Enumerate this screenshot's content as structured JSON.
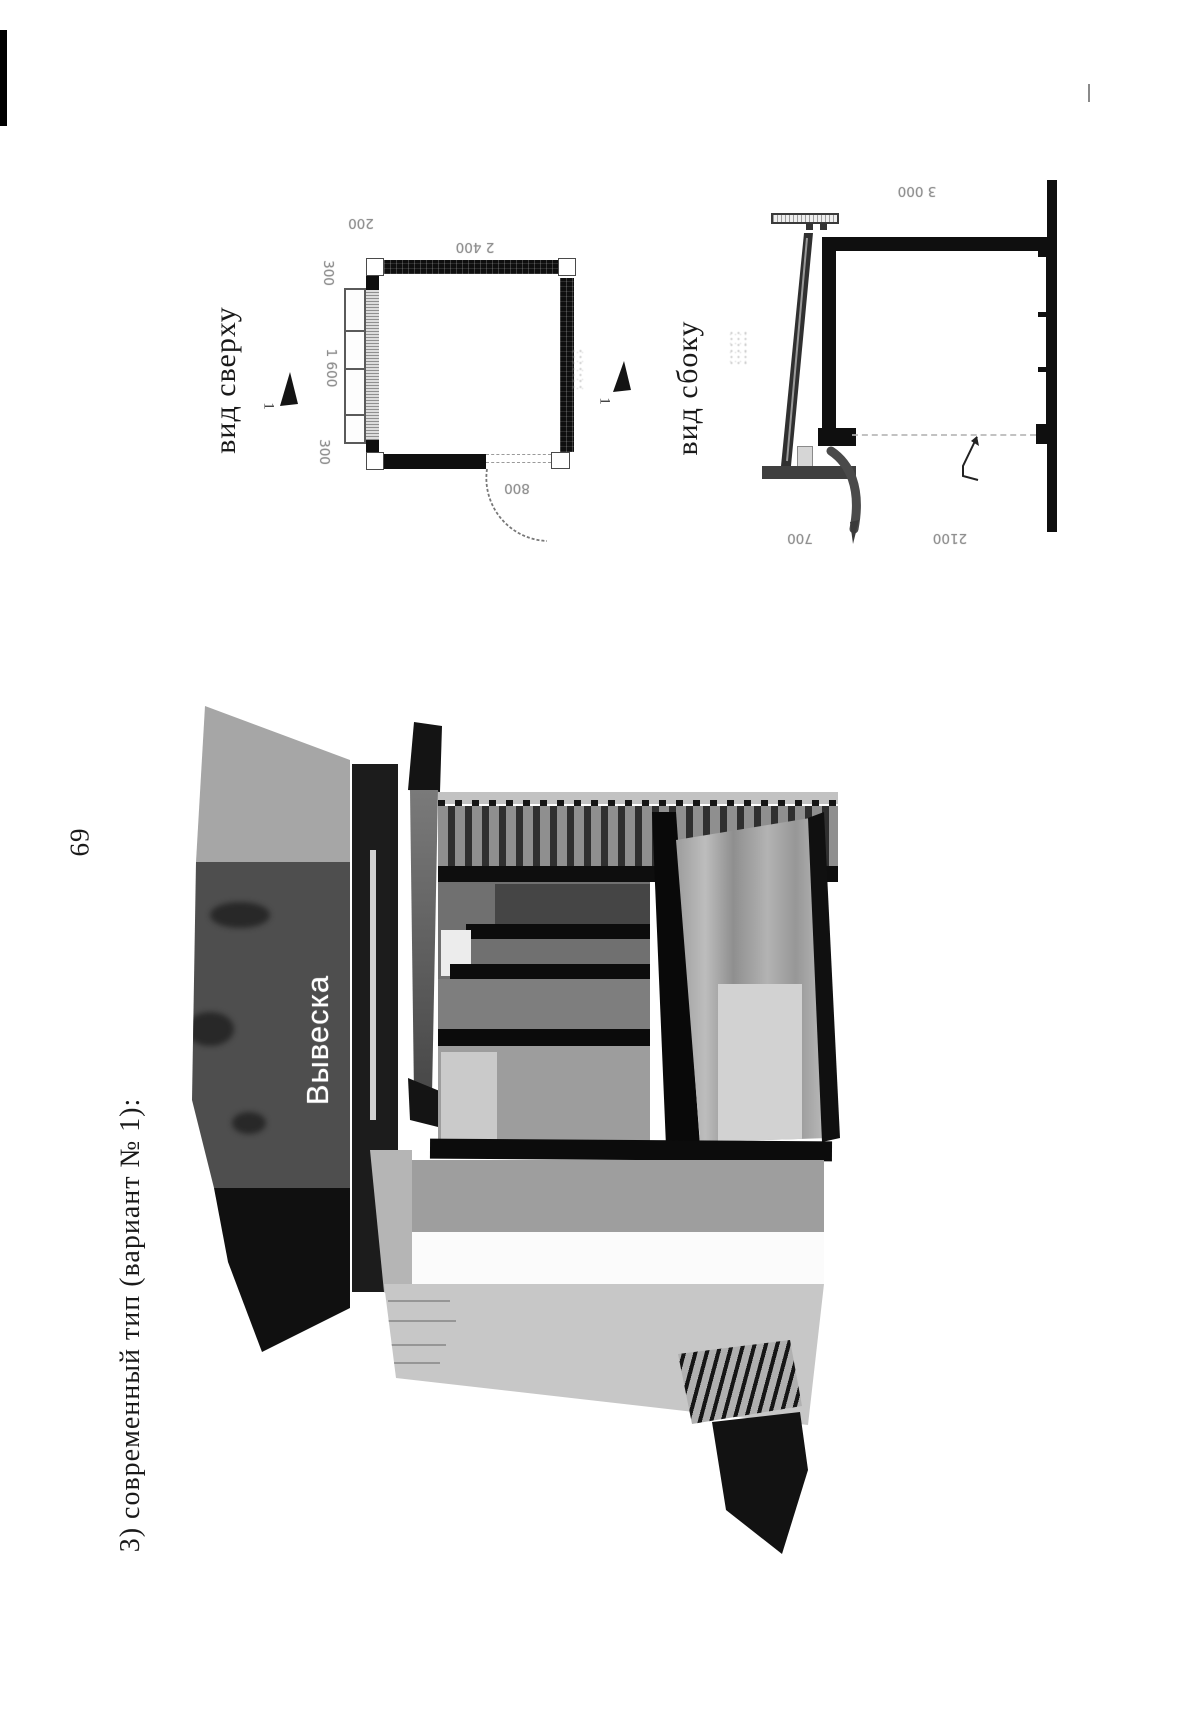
{
  "page": {
    "number": "69",
    "caption": "3) современный тип (вариант № 1):"
  },
  "figure": {
    "top_view": {
      "label": "вид сверху",
      "section_number": "1",
      "dimensions": {
        "wall_offset": "200",
        "width": "2 400",
        "side_top": "300",
        "side_middle": "1 600",
        "side_bottom": "300",
        "door_width": "800"
      }
    },
    "side_view": {
      "label": "вид сбоку",
      "section_number": "1",
      "dimensions": {
        "total_height": "3 000",
        "sign_height": "700",
        "opening_height": "2100"
      }
    },
    "render": {
      "sign_text": "Вывеска"
    }
  },
  "colors": {
    "paper": "#ffffff",
    "ink": "#101010",
    "dim_text": "#8f8f8f",
    "render_dark": "#4e4e4e",
    "render_light": "#c7c7c7"
  }
}
